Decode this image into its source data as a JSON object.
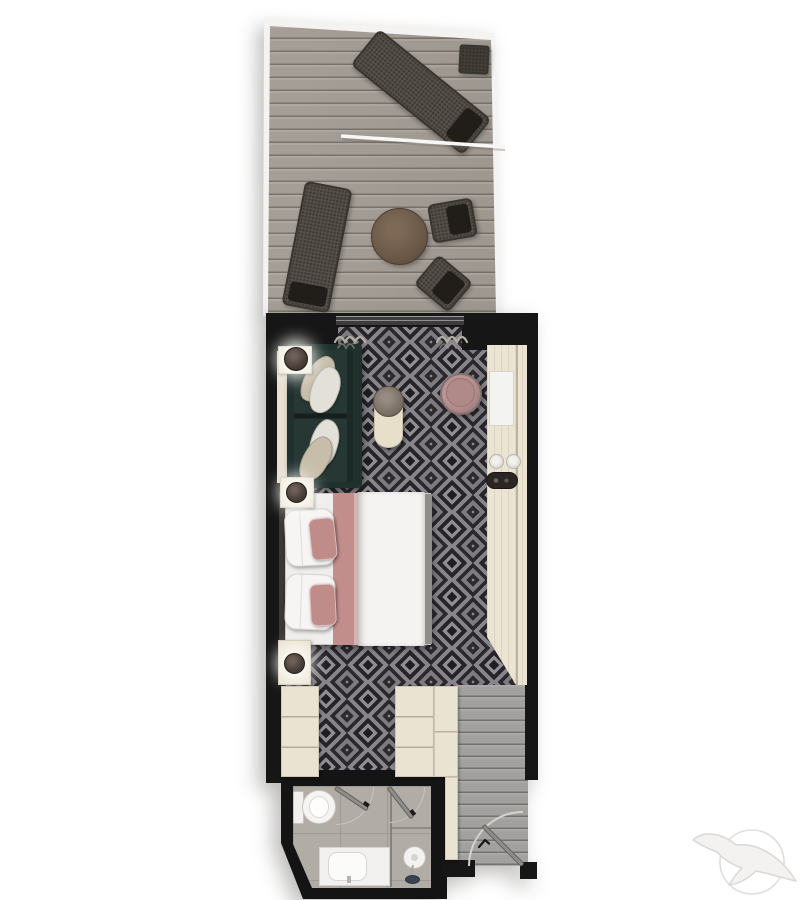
{
  "plan": {
    "name": "Balcony stateroom floor plan",
    "rooms": [
      {
        "id": "balcony",
        "label": "Balcony",
        "furniture": [
          "sun lounger",
          "sun lounger",
          "side table",
          "round table",
          "deck chair",
          "deck chair",
          "privacy divider"
        ]
      },
      {
        "id": "living-area",
        "label": "Sitting area",
        "furniture": [
          "sofa",
          "scatter cushions",
          "drum side table",
          "swivel chair",
          "vanity desk",
          "desk panel",
          "cups",
          "tray",
          "table lamp",
          "curtains",
          "sliding glass door"
        ]
      },
      {
        "id": "bedroom",
        "label": "Bedroom",
        "furniture": [
          "double bed",
          "pillows",
          "rose bed runner",
          "duvet",
          "nightstand",
          "nightstand",
          "table lamp",
          "table lamp"
        ]
      },
      {
        "id": "wardrobe",
        "label": "Wardrobe area",
        "furniture": [
          "wardrobe",
          "shelf unit",
          "shelf unit"
        ]
      },
      {
        "id": "entry",
        "label": "Entry hall",
        "furniture": [
          "entry door",
          "door swing arc"
        ]
      },
      {
        "id": "bathroom",
        "label": "Bathroom",
        "furniture": [
          "toilet",
          "washbasin vanity",
          "shower",
          "bathroom door",
          "shower door"
        ]
      }
    ],
    "logo": {
      "name": "seabird-cruise-logo",
      "color": "#e4e3e1"
    },
    "colors": {
      "background": "#ffffff",
      "walls": "#161616",
      "carpet_dark": "#29272b",
      "carpet_light": "#8d8a8d",
      "deck_wood": "#a7a098",
      "entry_wood": "#a2a19f",
      "bath_tile": "#b1aca6",
      "cabinetry": "#ebe4d3",
      "sofa": "#22312e",
      "bed_accent_rose": "#c28e8c",
      "chair_rose": "#ad8786",
      "linen_white": "#f4f3f1",
      "lounger_dark": "#56504a"
    }
  }
}
